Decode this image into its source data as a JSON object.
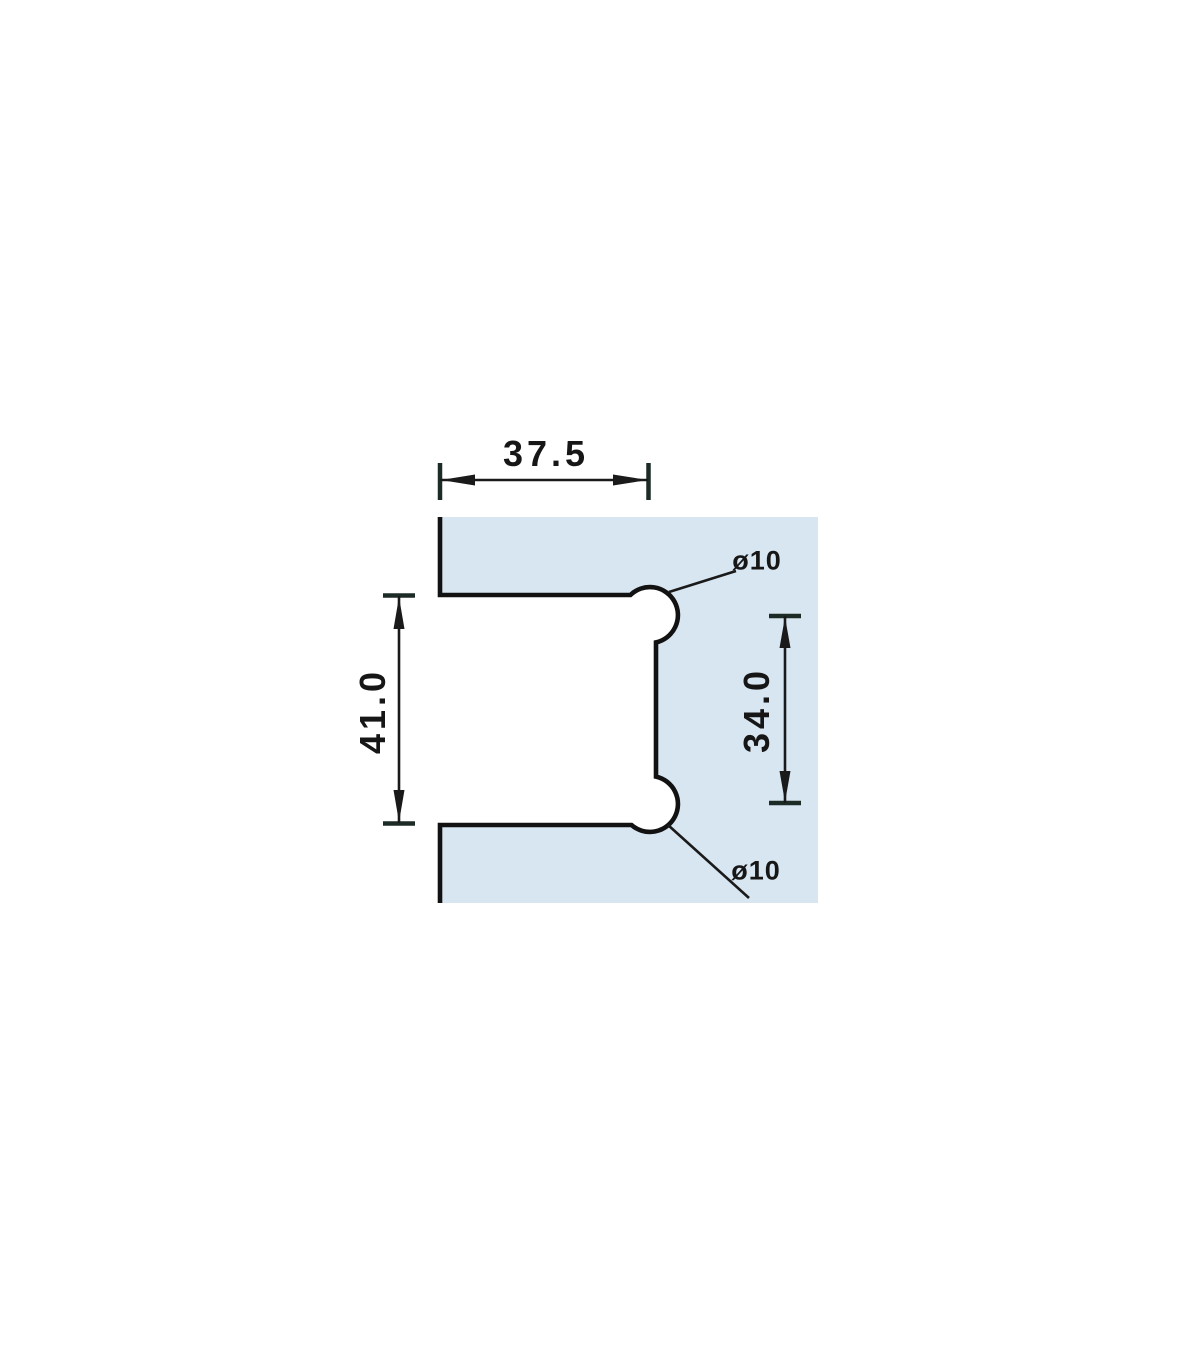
{
  "drawing": {
    "title": "Glass cutout technical drawing",
    "dimensions": {
      "notch_width": "37.5",
      "notch_height": "41.0",
      "hole_spacing": "34.0",
      "hole_top_diameter": "ø10",
      "hole_bottom_diameter": "ø10"
    },
    "colors": {
      "glass_fill": "#d8e6f2",
      "outline": "#121212",
      "dimension_line": "#1a1a1a",
      "extension_tick": "#1d2b26",
      "background": "#ffffff"
    }
  }
}
